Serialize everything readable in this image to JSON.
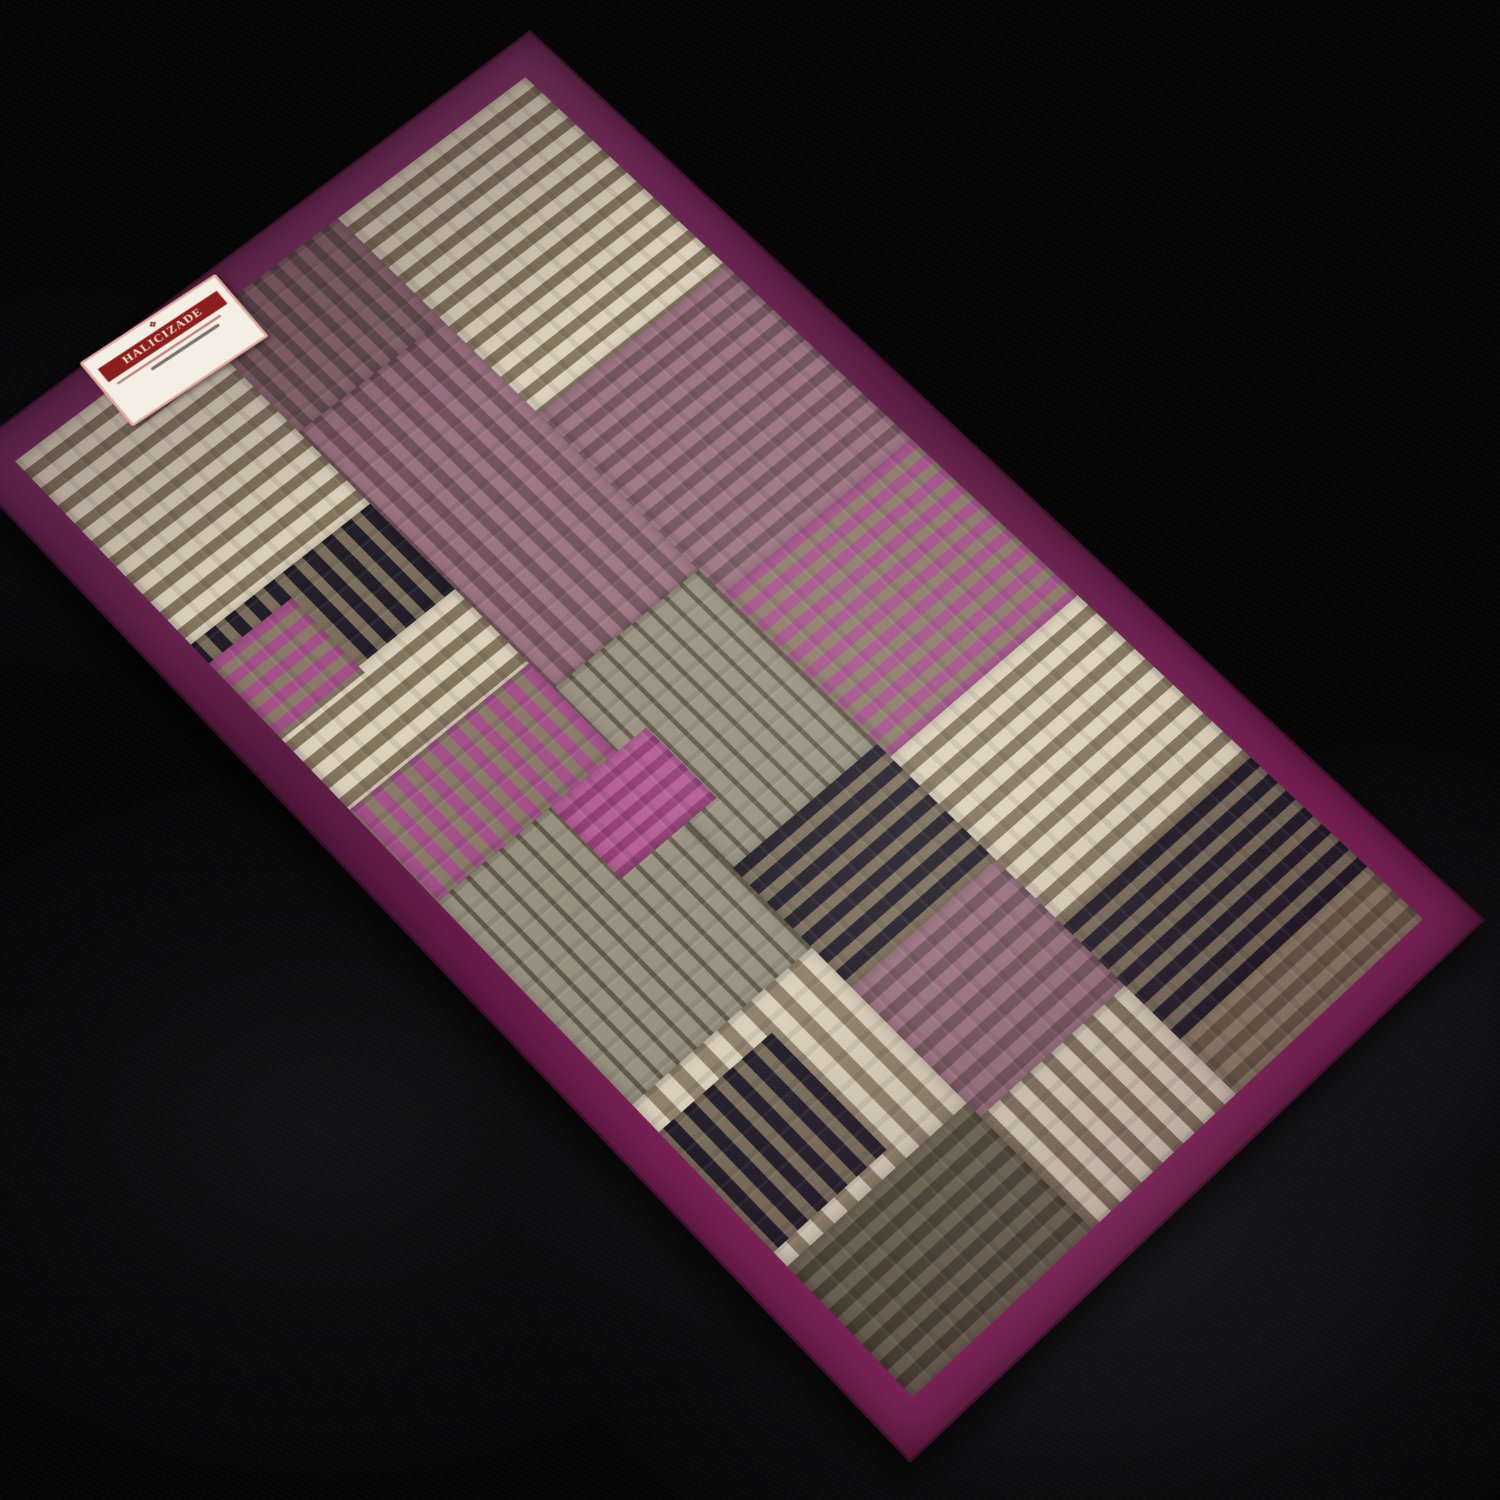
{
  "scene": {
    "description": "Patchwork striped runner rug with plum border photographed diagonally on a dark fabric floor",
    "floor_color": "#050506",
    "floor_sheen_color": "#8c8c96"
  },
  "label": {
    "brand": "HALICIZADE",
    "crest_icon": "❖",
    "card_bg": "#f4efe5",
    "card_border": "#e2a79e",
    "banner_bg": "#8c1f1d",
    "banner_text_color": "#f6efe2"
  },
  "rug": {
    "border_color_dark": "#5e1d45",
    "border_color_bright": "#8c2a64",
    "field_base": "#7a6b57",
    "palettes": {
      "cream": {
        "stripe": "#dcd2bc",
        "base": "#84755f",
        "sw": 16,
        "gw": 13
      },
      "creamB": {
        "stripe": "#d9cfba",
        "base": "#8e8069",
        "sw": 18,
        "gw": 14
      },
      "rose": {
        "stripe": "#9b7281",
        "base": "#72525c",
        "sw": 14,
        "gw": 12
      },
      "roseB": {
        "stripe": "#8f6b74",
        "base": "#635054",
        "sw": 13,
        "gw": 11
      },
      "magenta": {
        "stripe": "#a4518a",
        "base": "#8a7b68",
        "sw": 13,
        "gw": 12
      },
      "magentaBright": {
        "stripe": "#b55e97",
        "base": "#953f77",
        "sw": 12,
        "gw": 10
      },
      "navy": {
        "stripe": "#221e2a",
        "base": "#7b6e5c",
        "sw": 14,
        "gw": 12
      },
      "grey": {
        "stripe": "#615a4a",
        "base": "#989180",
        "sw": 5,
        "gw": 17
      },
      "taupe": {
        "stripe": "#93836c",
        "base": "#6b5c49",
        "sw": 12,
        "gw": 12
      },
      "olive": {
        "stripe": "#716a56",
        "base": "#4d4637",
        "sw": 12,
        "gw": 12
      }
    },
    "blocks": [
      {
        "x": 0,
        "y": 0,
        "w": 340,
        "h": 270,
        "p": "cream",
        "d": "across"
      },
      {
        "x": 340,
        "y": 0,
        "w": 300,
        "h": 270,
        "p": "rose",
        "d": "across"
      },
      {
        "x": 640,
        "y": 0,
        "w": 260,
        "h": 270,
        "p": "magenta",
        "d": "across"
      },
      {
        "x": 900,
        "y": 0,
        "w": 260,
        "h": 270,
        "p": "cream",
        "d": "across"
      },
      {
        "x": 1160,
        "y": 0,
        "w": 170,
        "h": 270,
        "p": "navy",
        "d": "across"
      },
      {
        "x": 1330,
        "y": 0,
        "w": 80,
        "h": 270,
        "p": "taupe",
        "d": "across"
      },
      {
        "x": 0,
        "y": 270,
        "w": 180,
        "h": 200,
        "p": "roseB",
        "d": "along"
      },
      {
        "x": 180,
        "y": 270,
        "w": 420,
        "h": 200,
        "p": "rose",
        "d": "along"
      },
      {
        "x": 600,
        "y": 270,
        "w": 280,
        "h": 200,
        "p": "grey",
        "d": "along"
      },
      {
        "x": 880,
        "y": 270,
        "w": 180,
        "h": 200,
        "p": "navy",
        "d": "across"
      },
      {
        "x": 1060,
        "y": 270,
        "w": 190,
        "h": 200,
        "p": "rose",
        "d": "across"
      },
      {
        "x": 1250,
        "y": 270,
        "w": 160,
        "h": 200,
        "p": "cream",
        "d": "along"
      },
      {
        "x": 0,
        "y": 470,
        "w": 300,
        "h": 240,
        "p": "cream",
        "d": "across"
      },
      {
        "x": 300,
        "y": 470,
        "w": 140,
        "h": 240,
        "p": "navy",
        "d": "along"
      },
      {
        "x": 440,
        "y": 470,
        "w": 120,
        "h": 240,
        "p": "cream",
        "d": "across"
      },
      {
        "x": 560,
        "y": 470,
        "w": 140,
        "h": 240,
        "p": "magenta",
        "d": "along"
      },
      {
        "x": 700,
        "y": 470,
        "w": 300,
        "h": 240,
        "p": "grey",
        "d": "along"
      },
      {
        "x": 1000,
        "y": 470,
        "w": 230,
        "h": 240,
        "p": "creamB",
        "d": "along"
      },
      {
        "x": 1230,
        "y": 470,
        "w": 180,
        "h": 240,
        "p": "olive",
        "d": "across"
      },
      {
        "x": 700,
        "y": 430,
        "w": 110,
        "h": 130,
        "p": "magentaBright",
        "d": "across"
      },
      {
        "x": 1040,
        "y": 560,
        "w": 170,
        "h": 150,
        "p": "navy",
        "d": "along"
      },
      {
        "x": 330,
        "y": 600,
        "w": 120,
        "h": 110,
        "p": "magenta",
        "d": "across"
      }
    ]
  }
}
